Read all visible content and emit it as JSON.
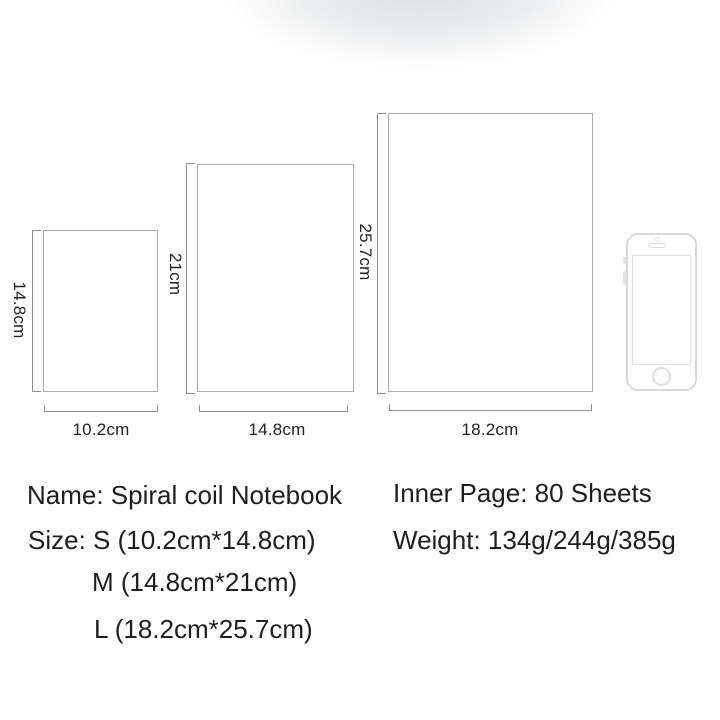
{
  "page": {
    "background_color": "#ffffff",
    "top_shade_color": "#dfe2e5",
    "line_color": "#8e9092",
    "outline_color": "#a9acae",
    "text_color": "#1e1e1e"
  },
  "diagram": {
    "sizes": [
      {
        "label": "S",
        "width_label": "10.2cm",
        "height_label": "14.8cm"
      },
      {
        "label": "M",
        "width_label": "14.8cm",
        "height_label": "21cm"
      },
      {
        "label": "L",
        "width_label": "18.2cm",
        "height_label": "25.7cm"
      }
    ],
    "scale_reference_icon": "smartphone-icon"
  },
  "details": {
    "name": "Name: Spiral coil Notebook",
    "size_s": "Size: S (10.2cm*14.8cm)",
    "size_m": "M (14.8cm*21cm)",
    "size_l": "L (18.2cm*25.7cm)",
    "inner_page": "Inner Page: 80 Sheets",
    "weight": "Weight: 134g/244g/385g"
  }
}
